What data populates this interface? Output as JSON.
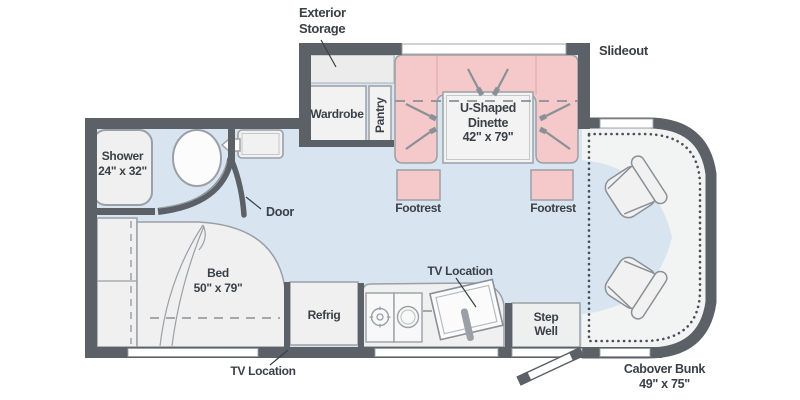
{
  "plan_title": "RV floor plan",
  "colors": {
    "wall": "#5c6167",
    "floor_blue": "#d8e5f0",
    "dinette_pink": "#f5c9ca",
    "furniture_gray": "#f0f0f0",
    "outline_gray": "#9aa0a6",
    "text": "#3a4047"
  },
  "labels": {
    "exterior_storage_1": "Exterior",
    "exterior_storage_2": "Storage",
    "slideout": "Slideout",
    "wardrobe": "Wardrobe",
    "pantry": "Pantry",
    "dinette_1": "U-Shaped",
    "dinette_2": "Dinette",
    "dinette_3": "42\" x 79\"",
    "footrest_left": "Footrest",
    "footrest_right": "Footrest",
    "shower_1": "Shower",
    "shower_2": "24\" x 32\"",
    "door": "Door",
    "bed_1": "Bed",
    "bed_2": "50\" x 79\"",
    "refrig": "Refrig",
    "tv_location_galley": "TV Location",
    "tv_location_bedroom": "TV Location",
    "step_well_1": "Step",
    "step_well_2": "Well",
    "cabover_1": "Cabover Bunk",
    "cabover_2": "49\" x 75\""
  }
}
